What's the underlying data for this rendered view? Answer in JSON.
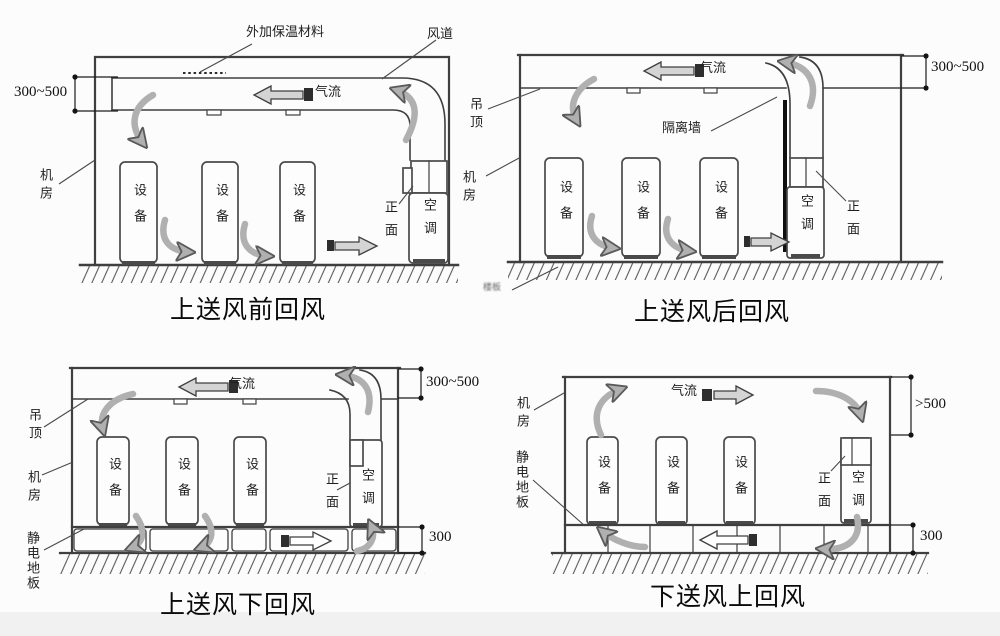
{
  "colors": {
    "line": "#3f3f3f",
    "arrow_fill": "#b0b0b0",
    "background": "#fcfcfc"
  },
  "panels": [
    {
      "title": "上送风前回风",
      "labels": {
        "insulation": "外加保温材料",
        "duct": "风道",
        "airflow": "气流",
        "dim_top": "300~500",
        "room": "机房",
        "equipment": "设备",
        "front": "正面",
        "ac": "空调"
      }
    },
    {
      "title": "上送风后回风",
      "labels": {
        "ceiling": "吊顶",
        "room": "机房",
        "airflow": "气流",
        "partition": "隔离墙",
        "equipment": "设备",
        "front": "正面",
        "ac": "空调",
        "dim_top": "300~500",
        "floor_slab": "楼板"
      }
    },
    {
      "title": "上送风下回风",
      "labels": {
        "ceiling": "吊顶",
        "room": "机房",
        "raised_floor": "静电地板",
        "airflow": "气流",
        "equipment": "设备",
        "front": "正面",
        "ac": "空调",
        "dim_top": "300~500",
        "dim_bottom": "300"
      }
    },
    {
      "title": "下送风上回风",
      "labels": {
        "room": "机房",
        "raised_floor": "静电地板",
        "airflow": "气流",
        "equipment": "设备",
        "front": "正面",
        "ac": "空调",
        "dim_top": ">500",
        "dim_bottom": "300"
      }
    }
  ]
}
